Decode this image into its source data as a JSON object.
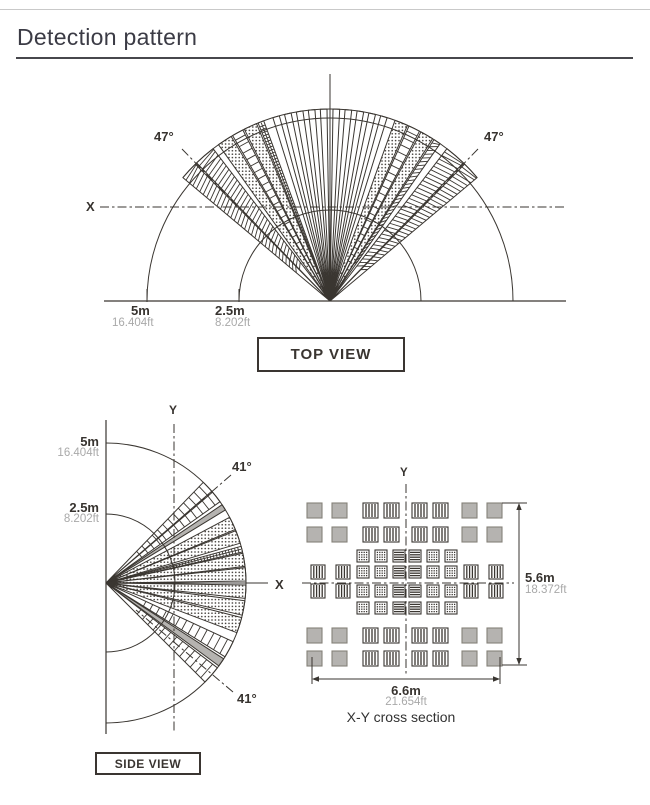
{
  "page": {
    "title": "Detection pattern"
  },
  "colors": {
    "ink": "#3a3631",
    "gray_fill": "#b5b3b0",
    "solid_border": "#858179",
    "dark_text": "#37332f",
    "muted_text": "#a9a9a9"
  },
  "top_view": {
    "box_label": "TOP VIEW",
    "angle_left": "47°",
    "angle_right": "47°",
    "x_axis_label": "X",
    "range_outer_m": "5m",
    "range_outer_ft": "16.404ft",
    "range_inner_m": "2.5m",
    "range_inner_ft": "8.202ft",
    "fan_beams": [
      {
        "a1": -50,
        "a2": -44.5,
        "fill": "hatch"
      },
      {
        "a1": -44,
        "a2": -37.5,
        "fill": "hatch"
      },
      {
        "a1": -35.5,
        "a2": -31,
        "fill": "dots"
      },
      {
        "a1": -30.5,
        "a2": -27,
        "fill": "lines"
      },
      {
        "a1": -26.5,
        "a2": -22.5,
        "fill": "dots"
      },
      {
        "a1": -22,
        "a2": -20.2,
        "fill": "dense"
      },
      {
        "a1": -17.3,
        "a2": -15.3,
        "fill": "white"
      },
      {
        "a1": -13.7,
        "a2": -11.7,
        "fill": "white"
      },
      {
        "a1": -10.1,
        "a2": -8.1,
        "fill": "white"
      },
      {
        "a1": -6.5,
        "a2": -4.5,
        "fill": "white"
      },
      {
        "a1": -2.9,
        "a2": -0.9,
        "fill": "white"
      },
      {
        "a1": 0.9,
        "a2": 2.9,
        "fill": "white"
      },
      {
        "a1": 4.5,
        "a2": 6.5,
        "fill": "white"
      },
      {
        "a1": 8.1,
        "a2": 10.1,
        "fill": "white"
      },
      {
        "a1": 11.7,
        "a2": 13.7,
        "fill": "white"
      },
      {
        "a1": 15.3,
        "a2": 17.3,
        "fill": "white"
      },
      {
        "a1": 19.8,
        "a2": 23.8,
        "fill": "dots"
      },
      {
        "a1": 24.3,
        "a2": 27.8,
        "fill": "lines"
      },
      {
        "a1": 28.3,
        "a2": 32.3,
        "fill": "dots"
      },
      {
        "a1": 32.8,
        "a2": 35,
        "fill": "hatch"
      },
      {
        "a1": 37.5,
        "a2": 44,
        "fill": "hatch"
      },
      {
        "a1": 44.5,
        "a2": 50,
        "fill": "hatch"
      }
    ]
  },
  "side_view": {
    "box_label": "SIDE VIEW",
    "angle_top": "41°",
    "angle_bottom": "41°",
    "x_axis_label": "X",
    "y_axis_label": "Y",
    "range_outer_m": "5m",
    "range_outer_ft": "16.404ft",
    "range_inner_m": "2.5m",
    "range_inner_ft": "8.202ft",
    "fan_beams": [
      {
        "a1": 46,
        "a2": 41,
        "fill": "lines"
      },
      {
        "a1": 40.5,
        "a2": 35.5,
        "fill": "lines"
      },
      {
        "a1": 34,
        "a2": 31.5,
        "fill": "gray"
      },
      {
        "a1": 28,
        "a2": 22.5,
        "fill": "dots"
      },
      {
        "a1": 22,
        "a2": 16.5,
        "fill": "dots"
      },
      {
        "a1": 15.2,
        "a2": 12.8,
        "fill": "dense"
      },
      {
        "a1": 12.3,
        "a2": 6.8,
        "fill": "dots"
      },
      {
        "a1": 6.3,
        "a2": 0.8,
        "fill": "dots"
      },
      {
        "a1": -0.8,
        "a2": -6.3,
        "fill": "dots"
      },
      {
        "a1": -7.3,
        "a2": -13.3,
        "fill": "dots"
      },
      {
        "a1": -14.3,
        "a2": -20.8,
        "fill": "dots"
      },
      {
        "a1": -24.8,
        "a2": -31.8,
        "fill": "lines"
      },
      {
        "a1": -32.8,
        "a2": -36.3,
        "fill": "gray"
      },
      {
        "a1": -37.3,
        "a2": -45,
        "fill": "lines"
      }
    ]
  },
  "cross_section": {
    "caption": "X-Y cross section",
    "y_axis_label": "Y",
    "height_m": "5.6m",
    "height_ft": "18.372ft",
    "width_m": "6.6m",
    "width_ft": "21.654ft",
    "grid_rows": [
      {
        "y": 503,
        "size": 15,
        "cells": [
          [
            307,
            "solid"
          ],
          [
            332,
            "solid"
          ],
          [
            363,
            "v"
          ],
          [
            384,
            "v"
          ],
          [
            412,
            "v"
          ],
          [
            433,
            "v"
          ],
          [
            462,
            "solid"
          ],
          [
            487,
            "solid"
          ]
        ]
      },
      {
        "y": 527,
        "size": 15,
        "cells": [
          [
            307,
            "solid"
          ],
          [
            332,
            "solid"
          ],
          [
            363,
            "v"
          ],
          [
            384,
            "v"
          ],
          [
            412,
            "v"
          ],
          [
            433,
            "v"
          ],
          [
            462,
            "solid"
          ],
          [
            487,
            "solid"
          ]
        ]
      },
      {
        "y": 550,
        "size": 12,
        "cells": [
          [
            357,
            "d"
          ],
          [
            375,
            "d"
          ],
          [
            393,
            "h"
          ],
          [
            409,
            "h"
          ],
          [
            427,
            "d"
          ],
          [
            445,
            "d"
          ]
        ]
      },
      {
        "y": 566,
        "size": 12,
        "cells": [
          [
            311,
            "v",
            14
          ],
          [
            336,
            "v",
            14
          ],
          [
            357,
            "d"
          ],
          [
            375,
            "d"
          ],
          [
            393,
            "h"
          ],
          [
            409,
            "h"
          ],
          [
            427,
            "d"
          ],
          [
            445,
            "d"
          ],
          [
            464,
            "v",
            14
          ],
          [
            489,
            "v",
            14
          ]
        ]
      },
      {
        "y": 585,
        "size": 12,
        "cells": [
          [
            311,
            "v",
            14
          ],
          [
            336,
            "v",
            14
          ],
          [
            357,
            "d"
          ],
          [
            375,
            "d"
          ],
          [
            393,
            "h"
          ],
          [
            409,
            "h"
          ],
          [
            427,
            "d"
          ],
          [
            445,
            "d"
          ],
          [
            464,
            "v",
            14
          ],
          [
            489,
            "v",
            14
          ]
        ]
      },
      {
        "y": 602,
        "size": 12,
        "cells": [
          [
            357,
            "d"
          ],
          [
            375,
            "d"
          ],
          [
            393,
            "h"
          ],
          [
            409,
            "h"
          ],
          [
            427,
            "d"
          ],
          [
            445,
            "d"
          ]
        ]
      },
      {
        "y": 628,
        "size": 15,
        "cells": [
          [
            307,
            "solid"
          ],
          [
            332,
            "solid"
          ],
          [
            363,
            "v"
          ],
          [
            384,
            "v"
          ],
          [
            412,
            "v"
          ],
          [
            433,
            "v"
          ],
          [
            462,
            "solid"
          ],
          [
            487,
            "solid"
          ]
        ]
      },
      {
        "y": 651,
        "size": 15,
        "cells": [
          [
            307,
            "solid"
          ],
          [
            332,
            "solid"
          ],
          [
            363,
            "v"
          ],
          [
            384,
            "v"
          ],
          [
            412,
            "v"
          ],
          [
            433,
            "v"
          ],
          [
            462,
            "solid"
          ],
          [
            487,
            "solid"
          ]
        ]
      }
    ]
  }
}
